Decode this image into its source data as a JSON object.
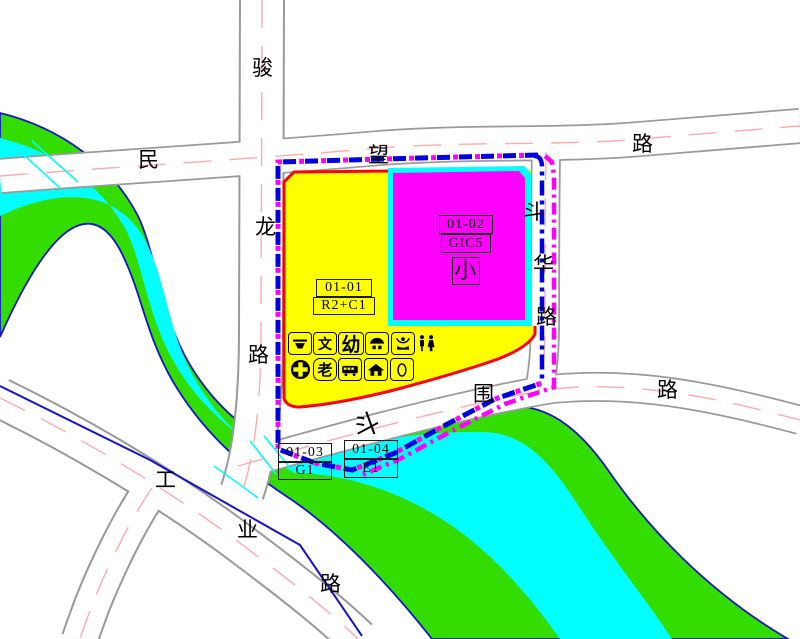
{
  "map_type": "regulatory-plan-map",
  "roads": {
    "junlong": {
      "name": "骏龙路",
      "chars": [
        "骏",
        "龙",
        "路"
      ]
    },
    "minwang": {
      "name": "民望路",
      "chars": [
        "民",
        "望",
        "路"
      ]
    },
    "douhua": {
      "name": "斗华路",
      "chars": [
        "斗",
        "华",
        "路"
      ]
    },
    "douwei": {
      "name": "斗围路",
      "chars": [
        "斗",
        "围",
        "路"
      ]
    },
    "gongye": {
      "name": "工业路",
      "chars": [
        "工",
        "业",
        "路"
      ]
    }
  },
  "parcels": {
    "p0101": {
      "id": "01-01",
      "code": "R2+C1"
    },
    "p0102": {
      "id": "01-02",
      "code": "GIC5",
      "note": "小"
    },
    "p0103": {
      "id": "01-03",
      "code": "G1"
    },
    "p0104": {
      "id": "01-04",
      "code": "E1"
    }
  },
  "facilities": {
    "row1": [
      {
        "name": "market-icon"
      },
      {
        "name": "culture-station-icon",
        "glyph": "文"
      },
      {
        "name": "kindergarten-icon",
        "glyph": "幼"
      },
      {
        "name": "canopy-stall-icon"
      },
      {
        "name": "community-service-icon"
      },
      {
        "name": "public-toilet-icon"
      }
    ],
    "row2": [
      {
        "name": "clinic-icon"
      },
      {
        "name": "elderly-care-icon",
        "glyph": "老"
      },
      {
        "name": "bus-station-icon"
      },
      {
        "name": "housing-office-icon"
      },
      {
        "name": "refuse-station-icon"
      }
    ]
  },
  "colors": {
    "residential_yellow": "#FFFF00",
    "public_magenta": "#FF00FF",
    "green_space": "#33DD00",
    "water_cyan": "#00FFFF",
    "plot_red_line": "#FF0000",
    "boundary_blue": "#0000E0",
    "boundary_magenta": "#FF00FF",
    "road_casing_gray": "#9a9a9a",
    "road_centerline_pink": "#ffabab",
    "bank_outline_blue": "#1414CC"
  }
}
